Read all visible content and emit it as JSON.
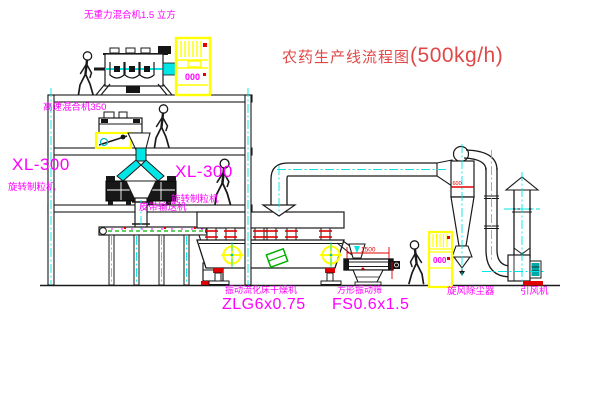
{
  "title": {
    "text": "农药生产线流程图",
    "capacity": "(500kg/h)"
  },
  "equipment_labels": {
    "gravity_mixer": "无重力混合机1.5 立方",
    "high_speed_mixer": "高速混合机350",
    "granulator_left": {
      "model": "XL-300",
      "name": "旋转制粒机"
    },
    "granulator_mid": {
      "model": "XL-300",
      "name": "旋转制粒机"
    },
    "belt_conveyor": "皮带输送机",
    "fluid_bed_dryer": {
      "name": "振动流化床干燥机",
      "model": "ZLG6x0.75"
    },
    "square_sieve": {
      "name": "方形振动筛",
      "model": "FS0.6x1.5"
    },
    "cyclone": "旋风除尘器",
    "induced_draft_fan": "引风机"
  },
  "dimensions": {
    "sieve_length": "1500",
    "cyclone_mark": "600"
  },
  "control_cabinets": {
    "display": "000"
  },
  "colors": {
    "label_magenta": "#ff00ff",
    "title_red": "#e04848",
    "centerline_cyan": "#00e5e5",
    "cabinet_yellow": "#ffff00",
    "accent_red": "#e00000",
    "machine_green": "#00b000"
  }
}
